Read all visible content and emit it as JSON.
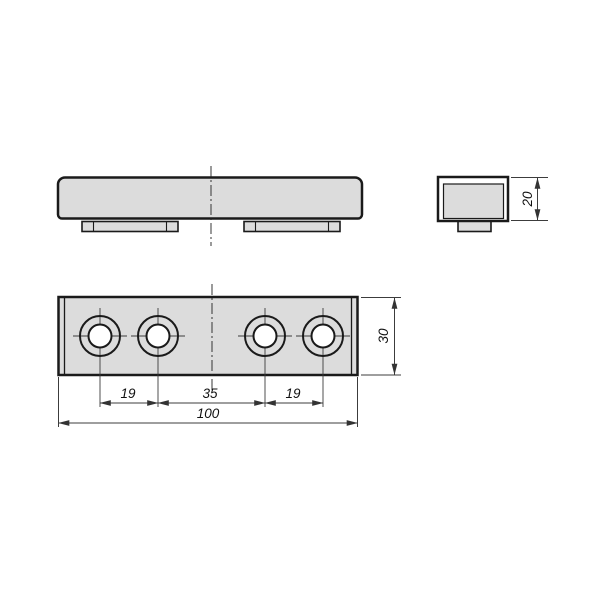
{
  "drawing": {
    "type": "technical-engineering-drawing",
    "part": "clamp plate with two feet and four counterbored holes",
    "colors": {
      "background": "#ffffff",
      "part_fill": "#dcdcdc",
      "outline": "#1a1a1a",
      "dimension_line": "#3c3c3c",
      "centerline": "#222222"
    },
    "views": {
      "front": {
        "description": "front elevation with two mounting feet and vertical centerline"
      },
      "side": {
        "dim_height": "20"
      },
      "plan": {
        "dim_spacing_left": "19",
        "dim_spacing_mid": "35",
        "dim_spacing_right": "19",
        "dim_overall_width": "100",
        "dim_depth": "30",
        "hole_count": "4"
      }
    }
  }
}
